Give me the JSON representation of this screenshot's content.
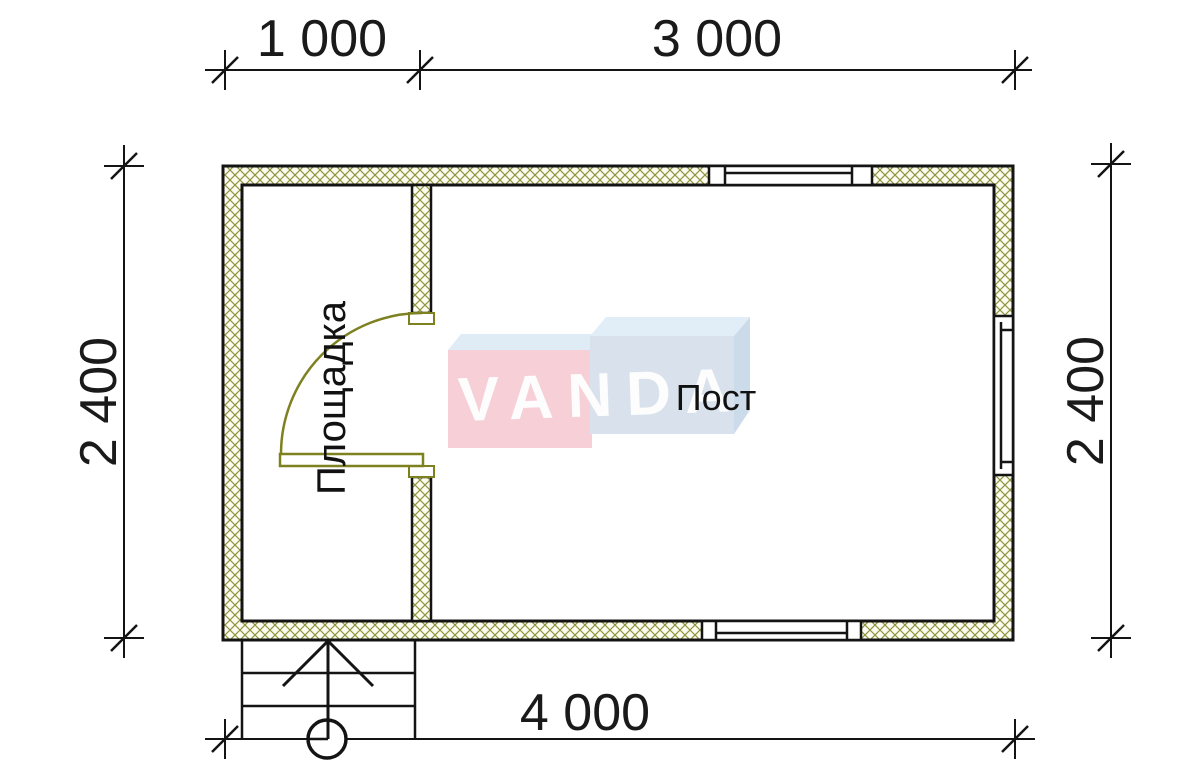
{
  "colors": {
    "background": "#ffffff",
    "line": "#141414",
    "hatch": "#8f9440",
    "wall_bg": "#fcfcf0",
    "door": "#7d811f",
    "text": "#1a1a1a"
  },
  "dimensions": {
    "top_left": "1 000",
    "top_right": "3 000",
    "left": "2 400",
    "right": "2 400",
    "bottom": "4 000"
  },
  "rooms": {
    "left_label": "Площадка",
    "main_label": "Пост"
  },
  "logo": {
    "text": "VANDA",
    "pink_face": "#f7c9d2",
    "pink_top": "#dbeaf4",
    "blue_face": "#d4dfea",
    "blue_top": "#ddecf7",
    "blue_side": "#c6d7e7",
    "text_color": "#fdfdfd"
  }
}
